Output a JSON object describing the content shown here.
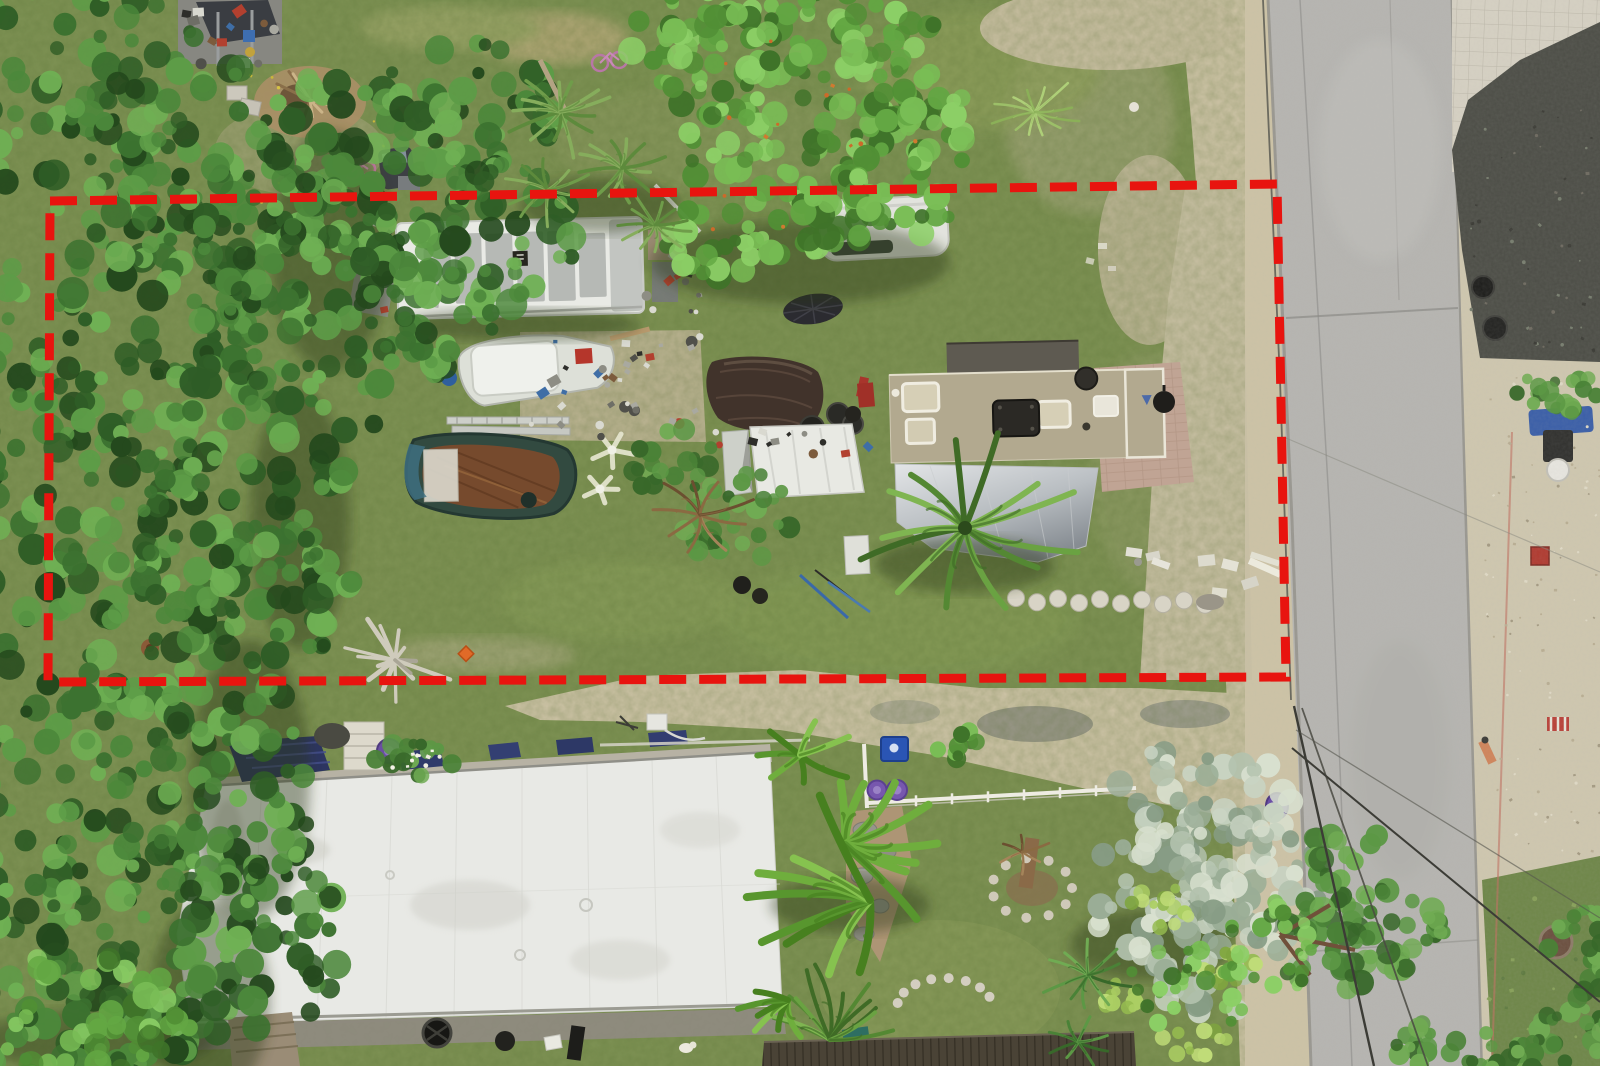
{
  "meta": {
    "title": "Aerial drone photo of residential lot with property boundary overlay",
    "width": 1600,
    "height": 1066,
    "scene_description": "Top-down drone photograph: dense tree canopy on the left, a cluttered lot with a storage trailer, boats, junk piles, a tan mobile home with silver awning and coconut palm, outlined by a red dashed property-boundary annotation; a gray asphalt road with gravel shoulders on the right; a large white metal roof home with solar panels and banana plants at the bottom."
  },
  "annotation": {
    "name": "property-boundary",
    "points": "50,201 1277,184 1286,677 48,682",
    "color": "#e8140f",
    "dash": "27 13",
    "stroke_width": "9"
  },
  "colors": {
    "grass": "#7e9254",
    "grass_bright": "#97a762",
    "grass_dark": "#5f7a40",
    "dirt": "#cdc3a6",
    "dirt_dark": "#b5ab8e",
    "road": "#b6b5b1",
    "road_edge": "#96948d",
    "gravel": "#cfc7af",
    "pavers": "#d6d1c3",
    "asphalt_dark": "#4c4d46",
    "trailer_roof": "#e9eae5",
    "trailer_patch": "#b6b9b5",
    "home_roof": "#b2a98f",
    "home_roof_dark": "#5e5a51",
    "awning_light": "#dde0e2",
    "awning_dark": "#8e9398",
    "patio": "#c0a494",
    "building_roof": "#e8e9e5",
    "deck": "#b7b2a4",
    "boardwalk": "#4a4336",
    "fence_white": "#eeece3",
    "bin_blue": "#2a55b4",
    "bucket_purple": "#7757ae",
    "tarp_brown": "#41332b",
    "tarp_navy": "#2d3560",
    "boat_white": "#dde0d8",
    "boat_rust": "#7a4a2c",
    "boat_hull": "#324a40",
    "palettes": {
      "forest": [
        "#24491d",
        "#2f5d26",
        "#3c7230",
        "#4c883b",
        "#5d9c47",
        "#6fb054"
      ],
      "bright": [
        "#3f7329",
        "#518f35",
        "#63a743",
        "#79bd55",
        "#8ccf66"
      ],
      "mid": [
        "#38682a",
        "#4a8237",
        "#5c9845",
        "#70ab53"
      ],
      "silver": [
        "#879c85",
        "#9aad96",
        "#b3c2ae",
        "#c8d3c2",
        "#d8e0cf"
      ],
      "yel": [
        "#7fa53f",
        "#95bb50",
        "#abce63",
        "#c0dc78"
      ],
      "palm": [
        "#3f6b26",
        "#548833",
        "#6aa242",
        "#7fb551"
      ],
      "feather": [
        "#5d8a3c",
        "#6f9c4a",
        "#86ad5c"
      ],
      "palmetto": [
        "#9cbf68",
        "#aecf78",
        "#8bb058"
      ],
      "dry": [
        "#8a6a42",
        "#a5845a",
        "#6b4f30"
      ],
      "banana": [
        "#47801f",
        "#58962e",
        "#6fae3d",
        "#86c24f"
      ],
      "junk": [
        "#6e6e66",
        "#8d8d84",
        "#50504a",
        "#a9a9a0",
        "#7c5b3c",
        "#b2402f",
        "#3f6ea6",
        "#d9d9d0",
        "#2e2e2a"
      ]
    }
  },
  "objects": {
    "labels": [
      "left tree canopy",
      "storage trailer",
      "white skiff boat",
      "derelict rusty boat",
      "junk piles",
      "brown tarp",
      "tan mobile home",
      "silver awning",
      "coconut palm",
      "white canopy tent",
      "white cargo van",
      "patio pavers",
      "stepping stones",
      "white metal roof house",
      "solar panels",
      "navy tarp",
      "blue recycling bin",
      "purple buckets",
      "white fence",
      "banana plants",
      "silver buttonwood tree",
      "asphalt road",
      "power lines",
      "gravel shoulder",
      "paver pad",
      "trash cans",
      "dirt driveway",
      "driftwood",
      "orange marker"
    ]
  }
}
